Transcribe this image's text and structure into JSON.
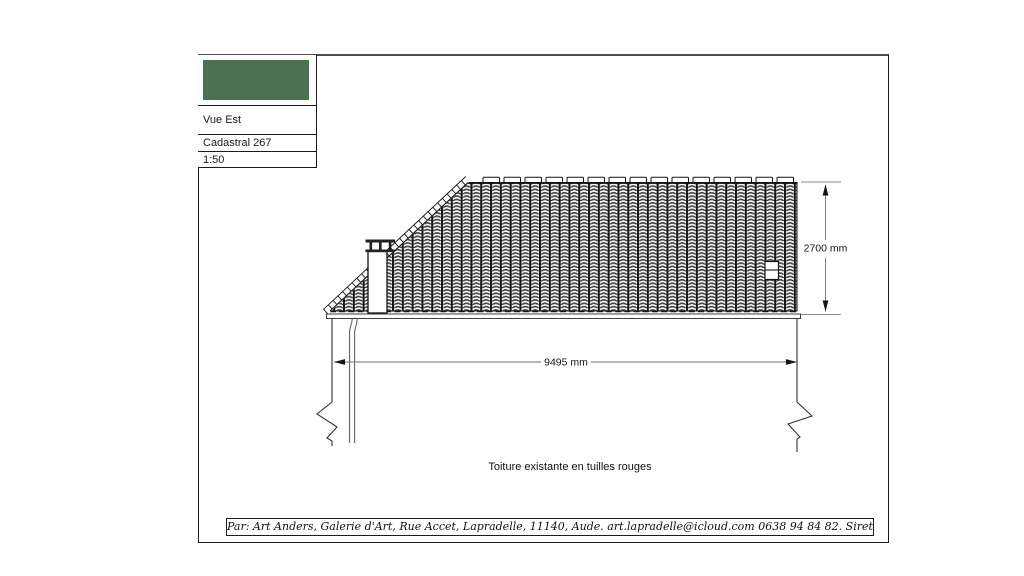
{
  "title_block": {
    "view": "Vue Est",
    "cadastral": "Cadastral 267",
    "scale": "1:50",
    "swatch_color": "#4b7150"
  },
  "dimensions": {
    "width_label": "9495 mm",
    "height_label": "2700 mm"
  },
  "caption": "Toiture existante en tuilles rouges",
  "footer": "Par: Art Anders, Galerie d'Art, Rue Accet, Lapradelle, 11140, Aude. art.lapradelle@icloud.com 0638 94 84 82. Siret: 845296227",
  "colors": {
    "line": "#1b1b1b",
    "dim_line": "#6e6e6e"
  }
}
